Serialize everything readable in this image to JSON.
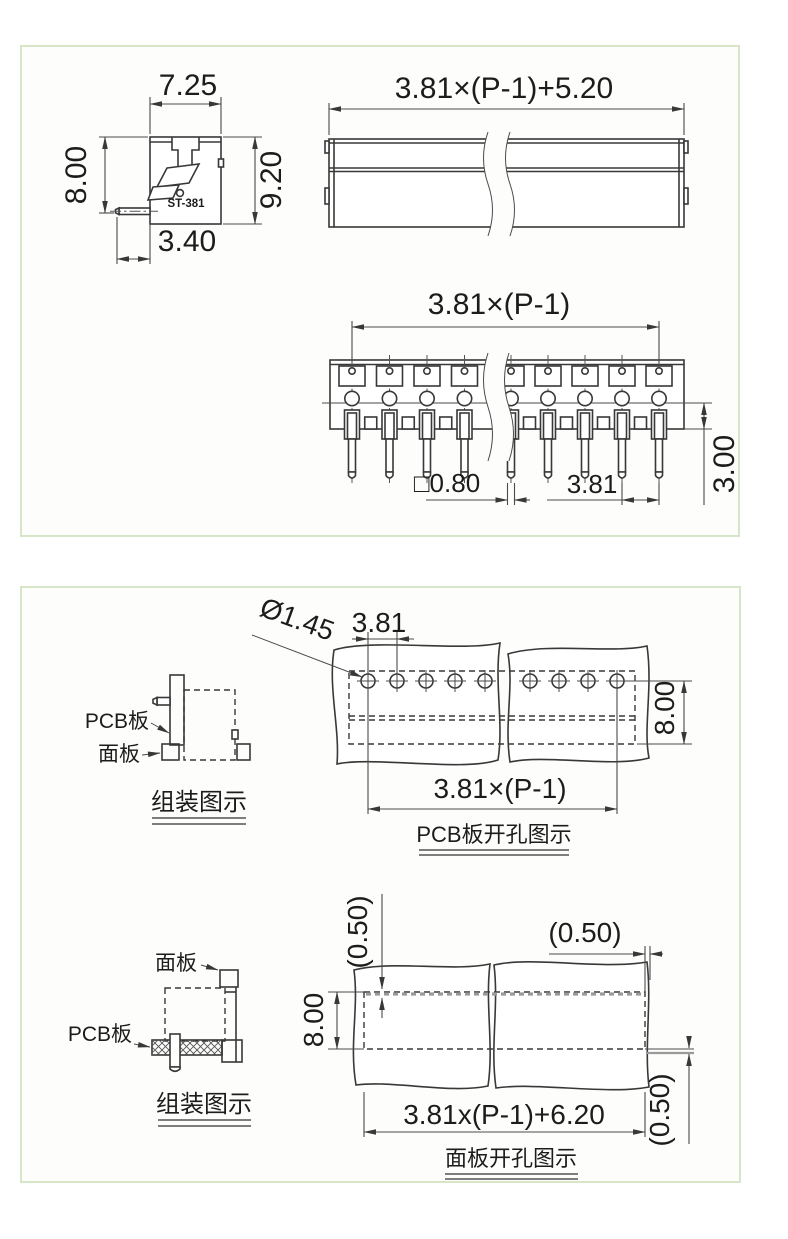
{
  "page": {
    "panel_border_color": "#d7e5c8",
    "line_color": "#383838",
    "background": "#ffffff"
  },
  "panel_top": {
    "side_view": {
      "model": "ST-381",
      "dim_width": "7.25",
      "dim_height": "8.00",
      "dim_total_height": "9.20",
      "dim_pin_offset": "3.40"
    },
    "front_view": {
      "dim_total_width": "3.81×(P-1)+5.20"
    },
    "bottom_view": {
      "dim_span": "3.81×(P-1)",
      "dim_pin_square": "□0.80",
      "dim_pitch": "3.81",
      "dim_pin_length": "3.00"
    }
  },
  "panel_bottom": {
    "assembly_top": {
      "label_pcb": "PCB板",
      "label_panel": "面板",
      "caption": "组装图示"
    },
    "pcb_drill": {
      "dim_hole": "Ø1.45",
      "dim_pitch": "3.81",
      "dim_height": "8.00",
      "dim_span": "3.81×(P-1)",
      "caption": "PCB板开孔图示"
    },
    "assembly_bottom": {
      "label_panel": "面板",
      "label_pcb": "PCB板",
      "caption": "组装图示"
    },
    "panel_cutout": {
      "dim_gap_top": "(0.50)",
      "dim_gap_right": "(0.50)",
      "dim_gap_bottom": "(0.50)",
      "dim_height": "8.00",
      "dim_width": "3.81x(P-1)+6.20",
      "caption": "面板开孔图示"
    }
  }
}
